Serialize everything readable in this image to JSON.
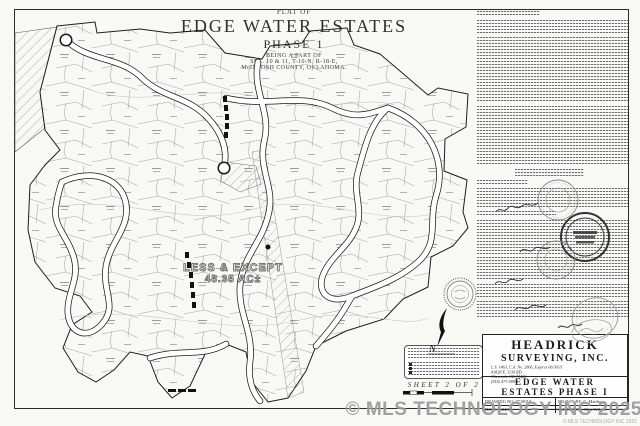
{
  "title_block": {
    "plat_of": "PLAT OF",
    "name": "EDGE WATER ESTATES",
    "phase": "PHASE 1",
    "being": "BEING A PART OF",
    "section": "SEC. 10 & 11, T-10-N, R-18-E,",
    "county": "McINTOSH COUNTY, OKLAHOMA."
  },
  "map": {
    "less_except_line1": "LESS & EXCEPT",
    "less_except_line2": "48.35 AC±",
    "north_label": "N"
  },
  "sheet_footer": {
    "sheet_label": "SHEET 2 OF 2"
  },
  "surveyor_block": {
    "firm_line1": "HEADRICK",
    "firm_line2": "SURVEYING, INC.",
    "license": "L.S. 1463, C.A. No. 2866, Expires 06/30/11",
    "address1": "41828 E. 1130 RD.",
    "address2": "Checotah, OK 74426",
    "phone": "(918) 473-5890",
    "project_line1": "EDGE WATER",
    "project_line2": "ESTATES PHASE I",
    "drawing_no": "DRAWING NO. 0710010",
    "drawn_by": "DRAWN BY: C. Matthews",
    "date": "DATE: 9/24/07",
    "customer": "CUSTOMER: Matt Wilson"
  },
  "watermark": {
    "text": "© MLS TECHNOLOGY INC 2025",
    "small_text": "© MLS TECHNOLOGY INC 2025",
    "color": "#979797"
  }
}
